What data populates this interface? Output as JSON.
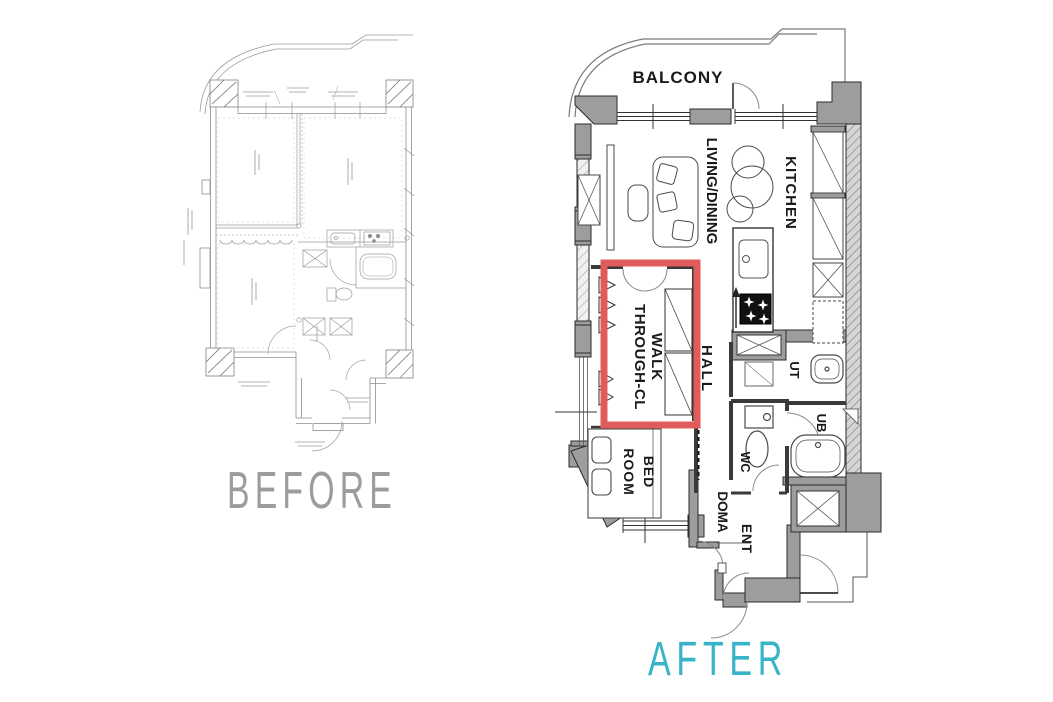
{
  "page": {
    "background": "#ffffff"
  },
  "before_plan": {
    "caption": "BEFORE",
    "caption_color": "#9c9c9c"
  },
  "after_plan": {
    "caption": "AFTER",
    "caption_color": "#38b4c8",
    "highlight_color": "#e05c5c",
    "labels": {
      "balcony": "BALCONY",
      "living_dining": "LIVING/DINING",
      "kitchen": "KITCHEN",
      "walk_through_line1": "WALK",
      "walk_through_line2": "THROUGH-CL",
      "hall": "HALL",
      "ut": "UT",
      "ub": "UB",
      "wc": "WC",
      "bedroom_line1": "BED",
      "bedroom_line2": "ROOM",
      "doma": "DOMA",
      "ent": "ENT"
    }
  }
}
